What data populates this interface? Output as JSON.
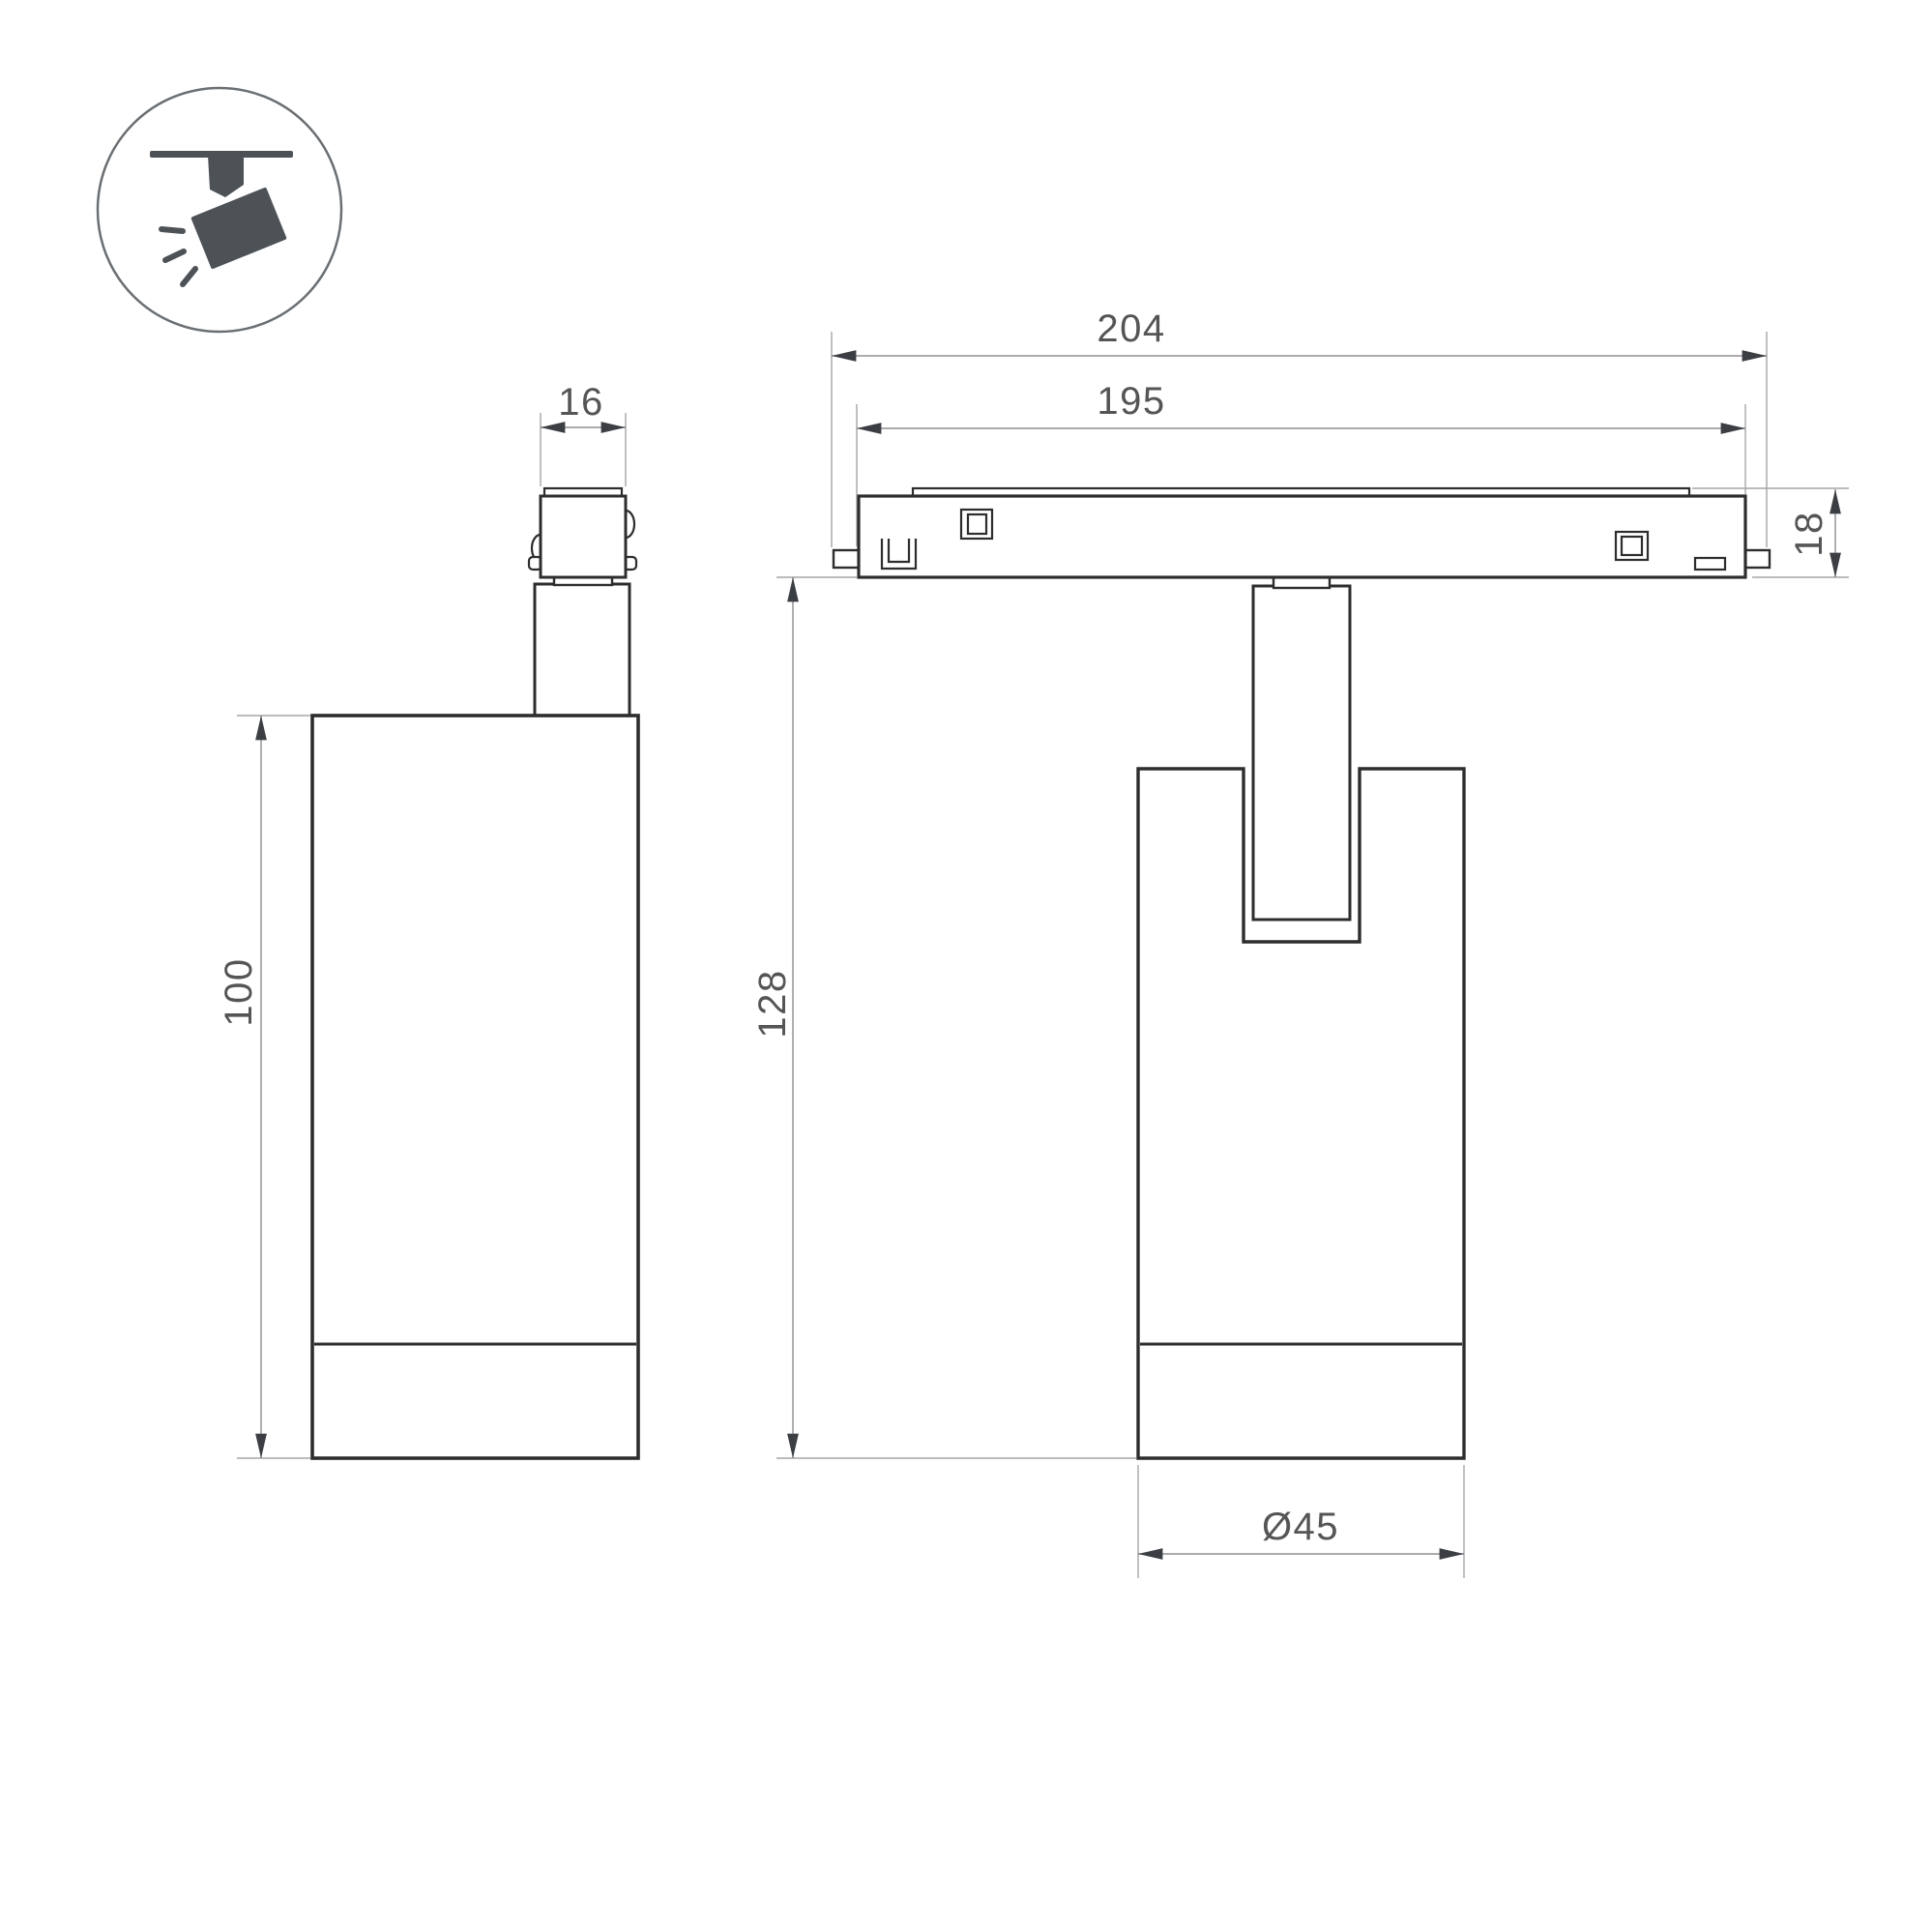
{
  "drawing": {
    "type": "technical-dimension-drawing",
    "subject": "magnetic-track-spotlight",
    "background_color": "#ffffff",
    "outline_color": "#2d2d2d",
    "dim_line_color": "#9a9a9a",
    "arrow_color": "#3b3f43",
    "text_color": "#555555",
    "icon_color": "#4d5257",
    "icon": {
      "name": "track-spotlight-pictogram"
    },
    "dimensions": {
      "track_full_length": "204",
      "track_body_length": "195",
      "adapter_width": "16",
      "track_height": "18",
      "total_height": "128",
      "body_height": "100",
      "body_diameter": "Ø45"
    }
  }
}
